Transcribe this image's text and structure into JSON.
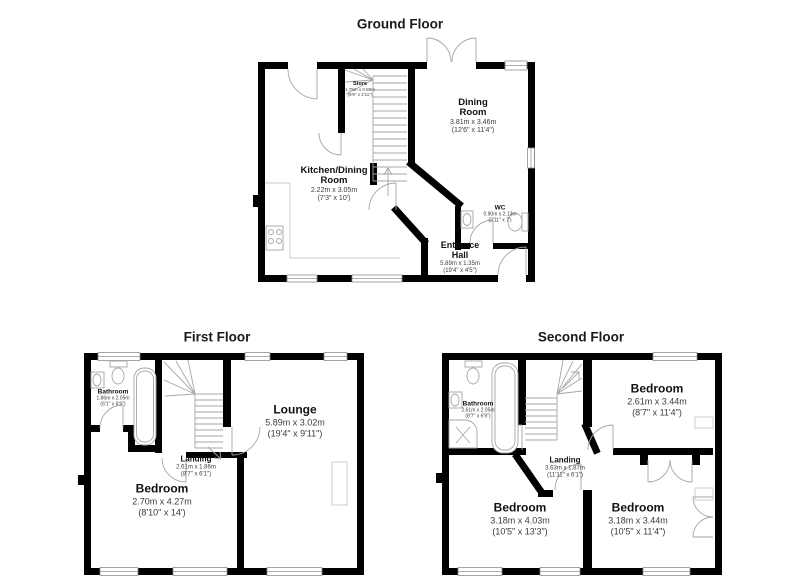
{
  "colors": {
    "walls": "#000000",
    "fixtures": "#a6a6a6",
    "background": "#ffffff",
    "text": "#111111"
  },
  "floors": [
    {
      "title": "Ground Floor",
      "rooms": [
        {
          "name": "Store",
          "metric": "1.75m x 0.89m",
          "imperial": "(5'9\" x 2'11\")"
        },
        {
          "name": "Kitchen/Dining Room",
          "metric": "2.22m x 3.05m",
          "imperial": "(7'3\" x 10')"
        },
        {
          "name": "Dining Room",
          "metric": "3.81m x 3.46m",
          "imperial": "(12'6\" x 11'4\")"
        },
        {
          "name": "WC",
          "metric": "0.90m x 2.13m",
          "imperial": "(2'11\" x 7')"
        },
        {
          "name": "Entrance Hall",
          "metric": "5.89m x 1.35m",
          "imperial": "(19'4\" x 4'5\")"
        }
      ]
    },
    {
      "title": "First Floor",
      "rooms": [
        {
          "name": "Bathroom",
          "metric": "1.86m x 2.05m",
          "imperial": "(6'1\" x 6'9\")"
        },
        {
          "name": "Landing",
          "metric": "2.61m x 1.86m",
          "imperial": "(8'7\" x 6'1\")"
        },
        {
          "name": "Lounge",
          "metric": "5.89m x 3.02m",
          "imperial": "(19'4\" x 9'11\")"
        },
        {
          "name": "Bedroom",
          "metric": "2.70m x 4.27m",
          "imperial": "(8'10\" x 14')"
        }
      ]
    },
    {
      "title": "Second Floor",
      "rooms": [
        {
          "name": "Bathroom",
          "metric": "2.61m x 2.05m",
          "imperial": "(8'7\" x 6'9\")"
        },
        {
          "name": "Bedroom",
          "metric": "2.61m x 3.44m",
          "imperial": "(8'7\" x 11'4\")"
        },
        {
          "name": "Landing",
          "metric": "3.63m x 1.87m",
          "imperial": "(11'11\" x 6'1\")"
        },
        {
          "name": "Bedroom",
          "metric": "3.18m x 4.03m",
          "imperial": "(10'5\" x 13'3\")"
        },
        {
          "name": "Bedroom",
          "metric": "3.18m x 3.44m",
          "imperial": "(10'5\" x 11'4\")"
        }
      ]
    }
  ]
}
